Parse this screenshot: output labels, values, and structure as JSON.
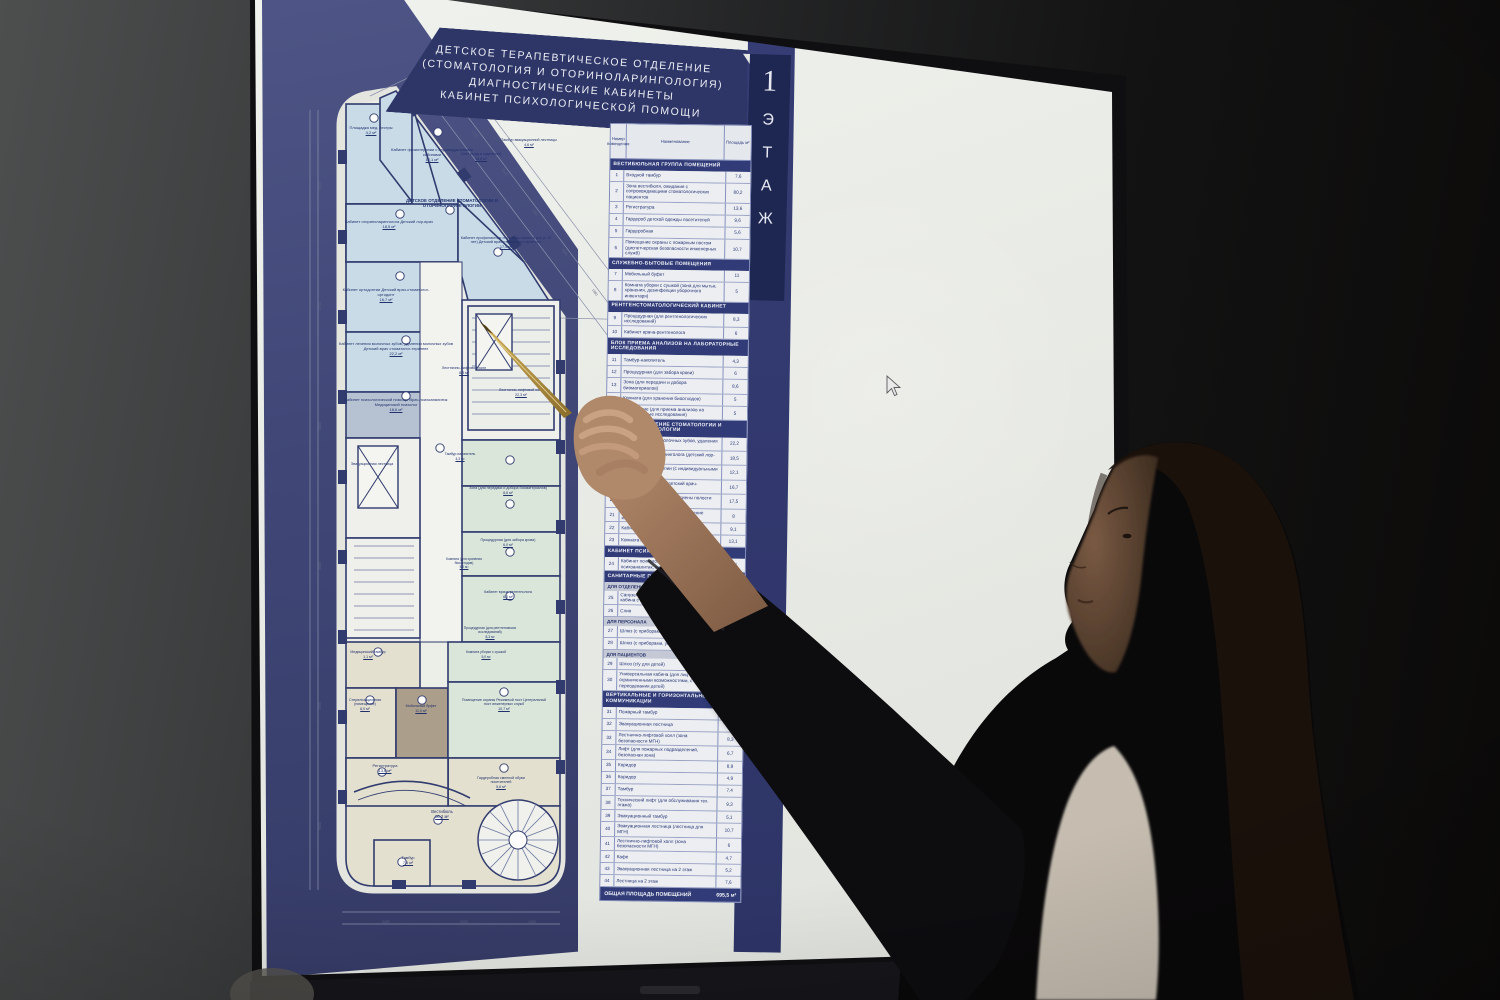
{
  "colors": {
    "accent_navy": "#2e3a78",
    "deep_navy": "#1c2550",
    "panel_blue": "#3f4677",
    "page": "#eaece7",
    "plan_room_blue": "#c9dde9",
    "plan_room_green": "#dce8dc",
    "plan_room_beige": "#e6e2d2",
    "plan_wall": "#2f3a6e",
    "skin": "#b08868",
    "pen_gold": "#b89647"
  },
  "display": {
    "title_lines": [
      "ДЕТСКОЕ ТЕРАПЕВТИЧЕСКОЕ ОТДЕЛЕНИЕ",
      "(СТОМАТОЛОГИЯ И ОТОРИНОЛАРИНГОЛОГИЯ)",
      "ДИАГНОСТИЧЕСКИЕ КАБИНЕТЫ",
      "КАБИНЕТ ПСИХОЛОГИЧЕСКОЙ ПОМОЩИ"
    ],
    "floor_tab": {
      "number": "1",
      "word": "ЭТАЖ"
    },
    "cursor": {
      "x": 888,
      "y": 378
    }
  },
  "plan": {
    "labels": [
      {
        "t": "Площадка мед. сестры",
        "a": "4,2 м²",
        "x": 76,
        "y": 126,
        "w": 66,
        "fs": 4
      },
      {
        "t": "Кабинет физиотерапии с индивидуальными кабинами",
        "a": "12,1 м²",
        "x": 126,
        "y": 148,
        "w": 88,
        "fs": 4
      },
      {
        "t": "Кабинет оториноларинголога Детский лор-врач",
        "a": "18,5 м²",
        "x": 74,
        "y": 220,
        "w": 106,
        "fs": 4
      },
      {
        "t": "ДЕТСКОЕ ОТДЕЛЕНИЕ СТОМАТОЛОГИИ И ОТОРИНОЛАРИНГОЛОГИИ",
        "x": 140,
        "y": 198,
        "w": 100,
        "fs": 4.4,
        "b": 1
      },
      {
        "t": "Кабинет профилактики и гигиены полости рта (с 12 лет) Детский врач-стоматолог-гигиенист",
        "a": "17,5 м²",
        "x": 198,
        "y": 236,
        "w": 92,
        "fs": 3.8
      },
      {
        "t": "Кабинет ортодонтии Детский врач-стоматолог-ортодонт",
        "a": "16,7 м²",
        "x": 74,
        "y": 288,
        "w": 100,
        "fs": 4
      },
      {
        "t": "Кабинет лечения молочных зубов, удаления молочных зубов Детский врач стоматолог-терапевт",
        "a": "22,2 м²",
        "x": 74,
        "y": 342,
        "w": 120,
        "fs": 4
      },
      {
        "t": "Кабинет психологической помощи Врач-психоаналитик Медицинский психолог",
        "a": "18,6 м²",
        "x": 74,
        "y": 398,
        "w": 120,
        "fs": 4
      },
      {
        "t": "Тамбур эвакуационной лестницы",
        "a": "4,6 м²",
        "x": 238,
        "y": 138,
        "w": 58,
        "fs": 3.6
      },
      {
        "t": "Холл (вход в отделение)",
        "a": "14,6 м²",
        "x": 196,
        "y": 152,
        "w": 46,
        "fs": 3.6
      },
      {
        "t": "Лестнично-лифтовой холл",
        "a": "8,3 м²",
        "x": 176,
        "y": 366,
        "w": 52,
        "fs": 3.6
      },
      {
        "t": "Лестнично-лифтовой холл",
        "a": "22,3 м²",
        "x": 232,
        "y": 388,
        "w": 54,
        "fs": 3.6
      },
      {
        "t": "Тамбур-накопитель",
        "a": "4,3 м²",
        "x": 176,
        "y": 452,
        "w": 44,
        "fs": 3.4
      },
      {
        "t": "Зона (для передачи и добора биоматериалов)",
        "a": "8,6 м²",
        "x": 206,
        "y": 486,
        "w": 80,
        "fs": 3.6
      },
      {
        "t": "Процедурная (для забора крови)",
        "a": "6,0 м²",
        "x": 214,
        "y": 538,
        "w": 64,
        "fs": 3.6
      },
      {
        "t": "Комната (для хранения биоотходов)",
        "a": "5,0 м²",
        "x": 178,
        "y": 558,
        "w": 48,
        "fs": 3.3
      },
      {
        "t": "Кабинет врача-рентгенолога",
        "a": "6,0 м²",
        "x": 216,
        "y": 590,
        "w": 60,
        "fs": 3.6
      },
      {
        "t": "Процедурная (для рентгеновских исследований)",
        "a": "8,3 м²",
        "x": 200,
        "y": 626,
        "w": 56,
        "fs": 3.4
      },
      {
        "t": "Эвакуационная лестница",
        "x": 82,
        "y": 462,
        "w": 56,
        "fs": 3.6
      },
      {
        "t": "Медицинский тамбур",
        "a": "1,1 м²",
        "x": 78,
        "y": 650,
        "w": 56,
        "fs": 3.6
      },
      {
        "t": "Стерилизационная (помещение)",
        "a": "8,0 м²",
        "x": 76,
        "y": 698,
        "w": 54,
        "fs": 3.6
      },
      {
        "t": "Мобильный буфет",
        "a": "11,0 м²",
        "x": 134,
        "y": 704,
        "w": 50,
        "fs": 3.6
      },
      {
        "t": "Комната уборки с сушкой",
        "a": "5,0 м²",
        "x": 196,
        "y": 650,
        "w": 56,
        "fs": 3.4
      },
      {
        "t": "Помещение охраны Режимный пост Центральный пост инженерных служб",
        "a": "10,7 м²",
        "x": 198,
        "y": 698,
        "w": 88,
        "fs": 3.6
      },
      {
        "t": "Гардеробная сменной обуви посетителей",
        "a": "5,6 м²",
        "x": 206,
        "y": 776,
        "w": 66,
        "fs": 3.6
      },
      {
        "t": "Регистратура",
        "a": "13,6 м²",
        "x": 90,
        "y": 764,
        "w": 66,
        "fs": 4
      },
      {
        "t": "Вестибюль",
        "a": "80,2 м²",
        "x": 150,
        "y": 810,
        "w": 60,
        "fs": 4.2
      },
      {
        "t": "Тамбур",
        "a": "7,6 м²",
        "x": 126,
        "y": 856,
        "w": 40,
        "fs": 3.8
      },
      {
        "t": "700",
        "x": 182,
        "y": 92,
        "fs": 3.5,
        "rot": 54,
        "col": "#5a6382"
      },
      {
        "t": "2700",
        "x": 212,
        "y": 130,
        "fs": 3.5,
        "rot": 54,
        "col": "#5a6382"
      },
      {
        "t": "3100",
        "x": 242,
        "y": 168,
        "fs": 3.5,
        "rot": 54,
        "col": "#5a6382"
      },
      {
        "t": "1940",
        "x": 272,
        "y": 208,
        "fs": 3.5,
        "rot": 54,
        "col": "#5a6382"
      },
      {
        "t": "5850",
        "x": 302,
        "y": 248,
        "fs": 3.5,
        "rot": 54,
        "col": "#5a6382"
      },
      {
        "t": "1950",
        "x": 332,
        "y": 288,
        "fs": 3.5,
        "rot": 54,
        "col": "#5a6382"
      },
      {
        "t": "7400",
        "x": 362,
        "y": 328,
        "fs": 3.5,
        "rot": 54,
        "col": "#5a6382"
      },
      {
        "t": "3500",
        "x": 56,
        "y": 190,
        "fs": 3.5,
        "rot": -90,
        "col": "#5a6382"
      },
      {
        "t": "2700",
        "x": 56,
        "y": 310,
        "fs": 3.5,
        "rot": -90,
        "col": "#5a6382"
      },
      {
        "t": "5850",
        "x": 56,
        "y": 430,
        "fs": 3.5,
        "rot": -90,
        "col": "#5a6382"
      },
      {
        "t": "3600",
        "x": 56,
        "y": 570,
        "fs": 3.5,
        "rot": -90,
        "col": "#5a6382"
      },
      {
        "t": "1950",
        "x": 56,
        "y": 710,
        "fs": 3.5,
        "rot": -90,
        "col": "#5a6382"
      },
      {
        "t": "9600",
        "x": 56,
        "y": 830,
        "fs": 3.5,
        "rot": -90,
        "col": "#5a6382"
      },
      {
        "t": "5400",
        "x": 120,
        "y": 920,
        "fs": 3.5,
        "col": "#5a6382"
      },
      {
        "t": "4000",
        "x": 198,
        "y": 920,
        "fs": 3.5,
        "col": "#5a6382"
      },
      {
        "t": "1930",
        "x": 266,
        "y": 920,
        "fs": 3.5,
        "col": "#5a6382"
      }
    ]
  },
  "table": {
    "columns": [
      "Номер помещения",
      "Наименование",
      "Площадь м²"
    ],
    "sections": [
      {
        "header": "ВЕСТИБЮЛЬНАЯ ГРУППА ПОМЕЩЕНИЙ",
        "rows": [
          [
            "1",
            "Входной тамбур",
            "7,6"
          ],
          [
            "2",
            "Зона вестибюля, ожидания с сопровождающими стоматологических пациентов",
            "80,2"
          ],
          [
            "3",
            "Регистратура",
            "13,6"
          ],
          [
            "4",
            "Гардероб детской одежды посетителей",
            "9,6"
          ],
          [
            "5",
            "Гардеробная",
            "5,6"
          ],
          [
            "6",
            "Помещение охраны с пожарным постом (диспетчерская безопасности инженерных служб)",
            "10,7"
          ]
        ]
      },
      {
        "header": "СЛУЖЕБНО-БЫТОВЫЕ ПОМЕЩЕНИЯ",
        "rows": [
          [
            "7",
            "Мобильный буфет",
            "11"
          ],
          [
            "8",
            "Комната уборки с сушкой (зона для мытья, хранения, дезинфекции уборочного инвентаря)",
            "5"
          ]
        ]
      },
      {
        "header": "РЕНТГЕНСТОМАТОЛОГИЧЕСКИЙ КАБИНЕТ",
        "rows": [
          [
            "9",
            "Процедурная (для рентгенологических исследований)",
            "8,3"
          ],
          [
            "10",
            "Кабинет врача-рентгенолога",
            "6"
          ]
        ]
      },
      {
        "header": "БЛОК ПРИЕМА АНАЛИЗОВ НА ЛАБОРАТОРНЫЕ ИССЛЕДОВАНИЯ",
        "rows": [
          [
            "11",
            "Тамбур-накопитель",
            "4,3"
          ],
          [
            "12",
            "Процедурная (для забора крови)",
            "6"
          ],
          [
            "13",
            "Зона (для передачи и добора биоматериалов)",
            "8,6"
          ],
          [
            "14",
            "Комната (для хранения биоотходов)",
            "5"
          ],
          [
            "15",
            "Помещение (для приема анализов на лабораторные исследования)",
            "5"
          ]
        ]
      },
      {
        "header": "ДЕТСКОЕ ОТДЕЛЕНИЕ СТОМАТОЛОГИИ И ОТОРИНОЛАРИНГОЛОГИИ",
        "rows": [
          [
            "16",
            "Кабинет лечения молочных зубов, удаления молочных зубов",
            "22,2"
          ],
          [
            "17",
            "Кабинет оториноларинголога (детский лор-врач)",
            "18,5"
          ],
          [
            "18",
            "Кабинет физиотерапии (с индивидуальными кабинами)",
            "12,1"
          ],
          [
            "19",
            "Кабинет ортодонтии (детский врач-стоматолог-ортодонт)",
            "16,7"
          ],
          [
            "20",
            "Кабинет профилактики и гигиены полости рта (с 12 лет)",
            "17,5"
          ],
          [
            "21",
            "Стерилизационная (мойка и хранение инструментария)",
            "8"
          ],
          [
            "22",
            "Кабинет врача",
            "9,1"
          ],
          [
            "23",
            "Комната персонала",
            "13,1"
          ]
        ]
      },
      {
        "header": "КАБИНЕТ ПСИХОЛОГИЧЕСКОЙ ПОМОЩИ",
        "rows": [
          [
            "24",
            "Кабинет психологической помощи (врач-психоаналитик, медицинский психолог)",
            "18,6"
          ]
        ]
      },
      {
        "header": "САНИТАРНЫЕ ПОМЕЩЕНИЯ",
        "subsections": [
          {
            "label": "ДЛЯ ОТДЕЛЕНИЙ",
            "rows": [
              [
                "25",
                "Санузел для посетителей (универсальная кабина с зоной для переодевания детей)",
                "5,6"
              ],
              [
                "26",
                "Слив",
                "3"
              ]
            ]
          },
          {
            "label": "ДЛЯ ПЕРСОНАЛА",
            "rows": [
              [
                "27",
                "Шлюз (с приборами, умывальником) 1 шт.",
                "3,6"
              ],
              [
                "28",
                "Шлюз (с приборами, умывальником) 2 шт.",
                "3,6"
              ]
            ]
          },
          {
            "label": "ДЛЯ ПАЦИЕНТОВ",
            "rows": [
              [
                "29",
                "Шлюз (с/у для детей)",
                "3,6"
              ],
              [
                "30",
                "Универсальная кабина (для лиц с ограниченными возможностями, с зоной для переодевания детей)",
                "3,7"
              ]
            ]
          }
        ]
      },
      {
        "header": "ВЕРТИКАЛЬНЫЕ И ГОРИЗОНТАЛЬНЫЕ КОММУНИКАЦИИ",
        "rows": [
          [
            "31",
            "Пожарный тамбур",
            "7,1"
          ],
          [
            "32",
            "Эвакуационная лестница",
            "15,6"
          ],
          [
            "33",
            "Лестнично-лифтовой холл (зона безопасности МГН)",
            "8,3"
          ],
          [
            "34",
            "Лифт (для пожарных подразделений, безопасная зона)",
            "6,7"
          ],
          [
            "35",
            "Коридор",
            "8,9"
          ],
          [
            "36",
            "Коридор",
            "4,9"
          ],
          [
            "37",
            "Тамбур",
            "7,4"
          ],
          [
            "38",
            "Технический лифт (для обслуживания тех. этажа)",
            "9,3"
          ],
          [
            "39",
            "Эвакуационный тамбур",
            "5,1"
          ],
          [
            "40",
            "Эвакуационная лестница (лестница для МГН)",
            "10,7"
          ],
          [
            "41",
            "Лестнично-лифтовой холл (зона безопасности МГН)",
            "6"
          ],
          [
            "42",
            "Кафе",
            "4,7"
          ],
          [
            "43",
            "Эвакуационная лестница на 2 этаж",
            "5,2"
          ],
          [
            "44",
            "Лестница на 2 этаж",
            "7,6"
          ]
        ]
      }
    ],
    "total": {
      "label": "ОБЩАЯ ПЛОЩАДЬ ПОМЕЩЕНИЙ",
      "value": "695,5 м²"
    }
  }
}
